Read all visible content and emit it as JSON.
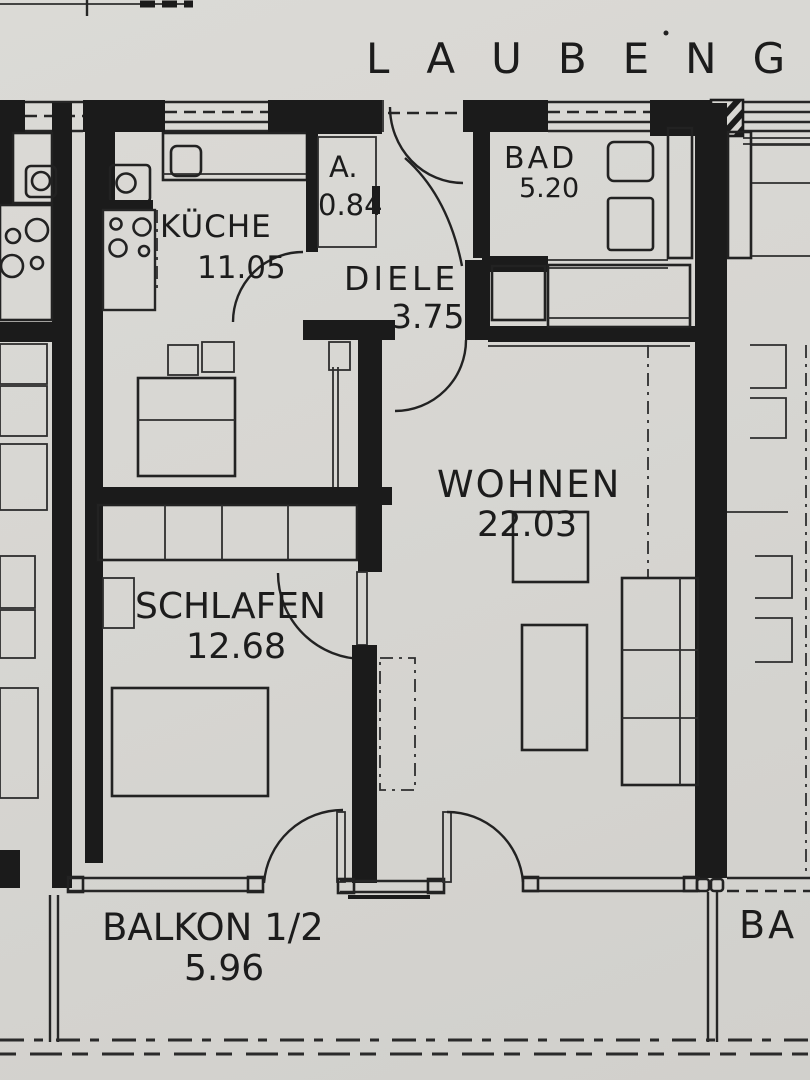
{
  "plan": {
    "corridor_label": "LAUBENG",
    "rooms": {
      "kueche": {
        "label": "KÜCHE",
        "area": "11.05"
      },
      "abstellraum": {
        "label": "A.",
        "area": "0.84"
      },
      "bad": {
        "label": "BAD",
        "area": "5.20"
      },
      "diele": {
        "label": "DIELE",
        "area": "3.75"
      },
      "wohnen": {
        "label": "WOHNEN",
        "area": "22.03"
      },
      "schlafen": {
        "label": "SCHLAFEN",
        "area": "12.68"
      },
      "balkon": {
        "label": "BALKON  1/2",
        "area": "5.96"
      },
      "neighbor_balcony_label": "BA"
    },
    "colors": {
      "paper": "#d8d7d3",
      "ink": "#1e1e1e"
    }
  }
}
